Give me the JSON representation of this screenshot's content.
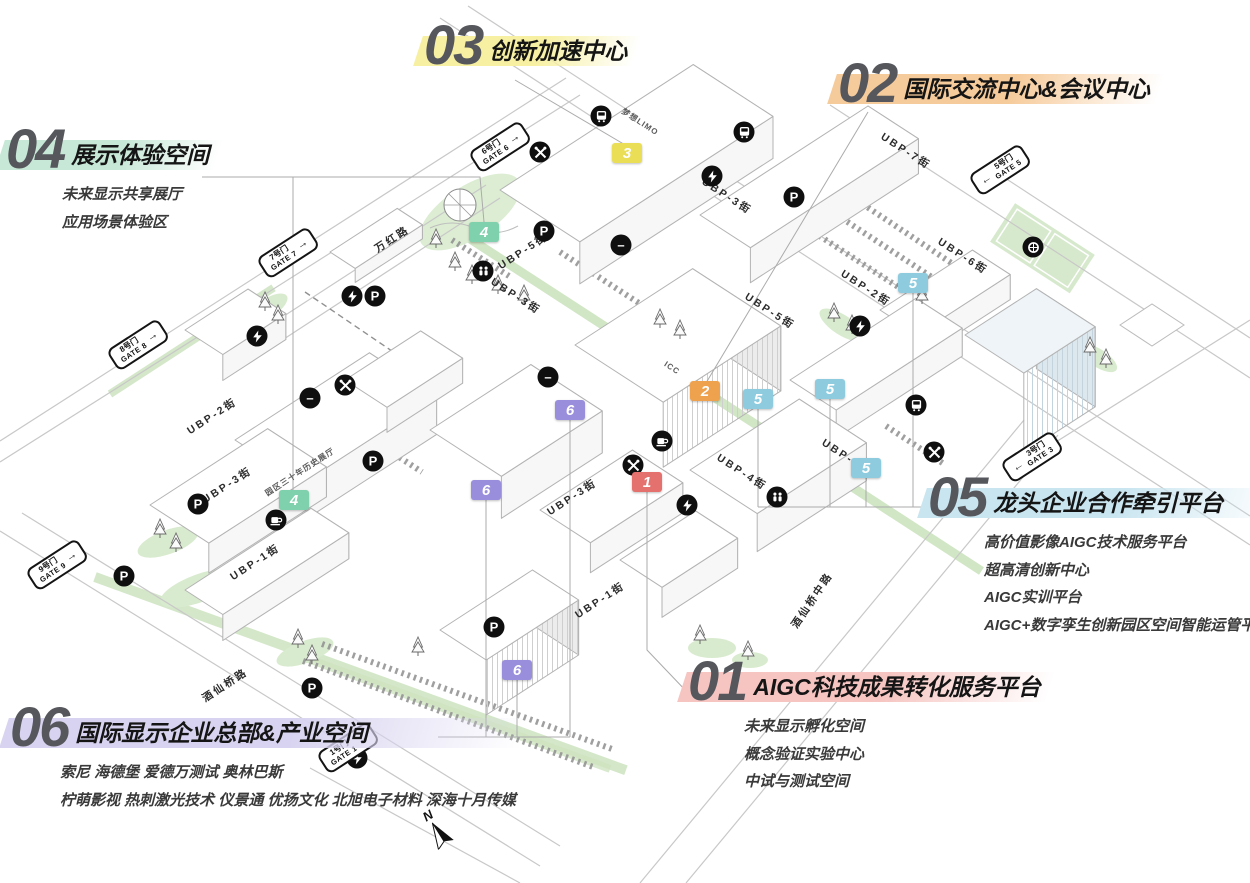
{
  "compass_label": "N",
  "zones": [
    {
      "id": "01",
      "num": "1",
      "title": "AIGC科技成果转化服务平台",
      "details": [
        "未来显示孵化空间",
        "概念验证实验中心",
        "中试与测试空间"
      ],
      "marker_color": "#e5716e",
      "band_color": "#f6c5c1",
      "x": 688,
      "y": 658,
      "markers": [
        [
          647,
          482
        ]
      ]
    },
    {
      "id": "02",
      "num": "2",
      "title": "国际交流中心&会议中心",
      "details": [],
      "marker_color": "#efa24e",
      "band_color": "#f6cb9b",
      "x": 838,
      "y": 60,
      "markers": [
        [
          705,
          391
        ]
      ]
    },
    {
      "id": "03",
      "num": "3",
      "title": "创新加速中心",
      "details": [],
      "marker_color": "#e9de55",
      "band_color": "#f7f0a2",
      "x": 424,
      "y": 22,
      "markers": [
        [
          627,
          153
        ]
      ]
    },
    {
      "id": "04",
      "num": "4",
      "title": "展示体验空间",
      "details": [
        "未来显示共享展厅",
        "应用场景体验区"
      ],
      "marker_color": "#7fd0ac",
      "band_color": "#c7e8d7",
      "x": 6,
      "y": 126,
      "markers": [
        [
          484,
          232
        ],
        [
          294,
          500
        ]
      ]
    },
    {
      "id": "05",
      "num": "5",
      "title": "龙头企业合作牵引平台",
      "details": [
        "高价值影像AIGC技术服务平台",
        "超高清创新中心",
        "AIGC实训平台",
        "AIGC+数字孪生创新园区空间智能运管平台"
      ],
      "marker_color": "#8ecbdf",
      "band_color": "#c9e5f0",
      "x": 928,
      "y": 474,
      "markers": [
        [
          913,
          283
        ],
        [
          830,
          389
        ],
        [
          758,
          399
        ],
        [
          866,
          468
        ]
      ]
    },
    {
      "id": "06",
      "num": "6",
      "title": "国际显示企业总部&产业空间",
      "details": [
        "索尼 海德堡 爱德万测试 奥林巴斯",
        "柠萌影视 热刺激光技术 仪景通 优扬文化 北旭电子材料 深海十月传媒"
      ],
      "marker_color": "#998edb",
      "band_color": "#d8d3f0",
      "x": 10,
      "y": 704,
      "markers": [
        [
          570,
          410
        ],
        [
          486,
          490
        ],
        [
          517,
          670
        ]
      ]
    }
  ],
  "gates": [
    {
      "cn": "1号门",
      "en": "GATE 1",
      "arrow": "→",
      "x": 348,
      "y": 748
    },
    {
      "cn": "3号门",
      "en": "GATE 3",
      "arrow": "←",
      "x": 1032,
      "y": 457
    },
    {
      "cn": "5号门",
      "en": "GATE 5",
      "arrow": "←",
      "x": 1000,
      "y": 170
    },
    {
      "cn": "6号门",
      "en": "GATE 6",
      "arrow": "→",
      "x": 500,
      "y": 147
    },
    {
      "cn": "7号门",
      "en": "GATE 7",
      "arrow": "→",
      "x": 288,
      "y": 253
    },
    {
      "cn": "8号门",
      "en": "GATE 8",
      "arrow": "→",
      "x": 138,
      "y": 345
    },
    {
      "cn": "9号门",
      "en": "GATE 9",
      "arrow": "→",
      "x": 57,
      "y": 565
    }
  ],
  "streets": [
    {
      "name": "万红路",
      "x": 392,
      "y": 239,
      "rot": -33
    },
    {
      "name": "UBP-5街",
      "x": 523,
      "y": 251,
      "rot": -33
    },
    {
      "name": "UBP-3街",
      "x": 516,
      "y": 296,
      "rot": 33
    },
    {
      "name": "UBP-3街",
      "x": 727,
      "y": 196,
      "rot": 33
    },
    {
      "name": "UBP-7街",
      "x": 906,
      "y": 151,
      "rot": 33
    },
    {
      "name": "UBP-6街",
      "x": 963,
      "y": 256,
      "rot": 33
    },
    {
      "name": "UBP-2街",
      "x": 866,
      "y": 288,
      "rot": 33
    },
    {
      "name": "UBP-5街",
      "x": 770,
      "y": 311,
      "rot": 33
    },
    {
      "name": "UBP-1街",
      "x": 847,
      "y": 457,
      "rot": 33
    },
    {
      "name": "UBP-4街",
      "x": 742,
      "y": 472,
      "rot": 33
    },
    {
      "name": "UBP-2街",
      "x": 212,
      "y": 416,
      "rot": -33
    },
    {
      "name": "UBP-3街",
      "x": 227,
      "y": 485,
      "rot": -33
    },
    {
      "name": "UBP-3街",
      "x": 572,
      "y": 497,
      "rot": -33
    },
    {
      "name": "UBP-1街",
      "x": 255,
      "y": 562,
      "rot": -33
    },
    {
      "name": "UBP-1街",
      "x": 600,
      "y": 600,
      "rot": -33
    },
    {
      "name": "酒仙桥路",
      "x": 225,
      "y": 685,
      "rot": -33
    },
    {
      "name": "酒仙桥中路",
      "x": 812,
      "y": 600,
      "rot": -56
    }
  ],
  "building_labels": [
    {
      "name": "梦想LIMO",
      "x": 640,
      "y": 122,
      "rot": 33
    },
    {
      "name": "ICC",
      "x": 672,
      "y": 368,
      "rot": 33
    },
    {
      "name": "园区三十年历史展厅",
      "x": 300,
      "y": 472,
      "rot": -33
    }
  ],
  "icons": [
    {
      "type": "parking",
      "x": 794,
      "y": 197
    },
    {
      "type": "parking",
      "x": 544,
      "y": 231
    },
    {
      "type": "parking",
      "x": 375,
      "y": 296
    },
    {
      "type": "parking",
      "x": 198,
      "y": 504
    },
    {
      "type": "parking",
      "x": 373,
      "y": 461
    },
    {
      "type": "parking",
      "x": 124,
      "y": 576
    },
    {
      "type": "parking",
      "x": 312,
      "y": 688
    },
    {
      "type": "parking",
      "x": 494,
      "y": 627
    },
    {
      "type": "ev-charging",
      "x": 712,
      "y": 176
    },
    {
      "type": "ev-charging",
      "x": 352,
      "y": 296
    },
    {
      "type": "ev-charging",
      "x": 257,
      "y": 336
    },
    {
      "type": "ev-charging",
      "x": 687,
      "y": 505
    },
    {
      "type": "ev-charging",
      "x": 860,
      "y": 326
    },
    {
      "type": "ev-charging",
      "x": 357,
      "y": 758
    },
    {
      "type": "bus",
      "x": 601,
      "y": 116
    },
    {
      "type": "bus",
      "x": 744,
      "y": 132
    },
    {
      "type": "bus",
      "x": 916,
      "y": 405
    },
    {
      "type": "dining",
      "x": 540,
      "y": 152
    },
    {
      "type": "dining",
      "x": 345,
      "y": 385
    },
    {
      "type": "dining",
      "x": 633,
      "y": 465
    },
    {
      "type": "dining",
      "x": 934,
      "y": 452
    },
    {
      "type": "cafe",
      "x": 662,
      "y": 441
    },
    {
      "type": "cafe",
      "x": 276,
      "y": 520
    },
    {
      "type": "restroom",
      "x": 777,
      "y": 497
    },
    {
      "type": "restroom",
      "x": 483,
      "y": 271
    },
    {
      "type": "sports",
      "x": 1033,
      "y": 247
    },
    {
      "type": "metro",
      "x": 621,
      "y": 245
    },
    {
      "type": "metro",
      "x": 310,
      "y": 398
    },
    {
      "type": "metro",
      "x": 548,
      "y": 377
    }
  ]
}
